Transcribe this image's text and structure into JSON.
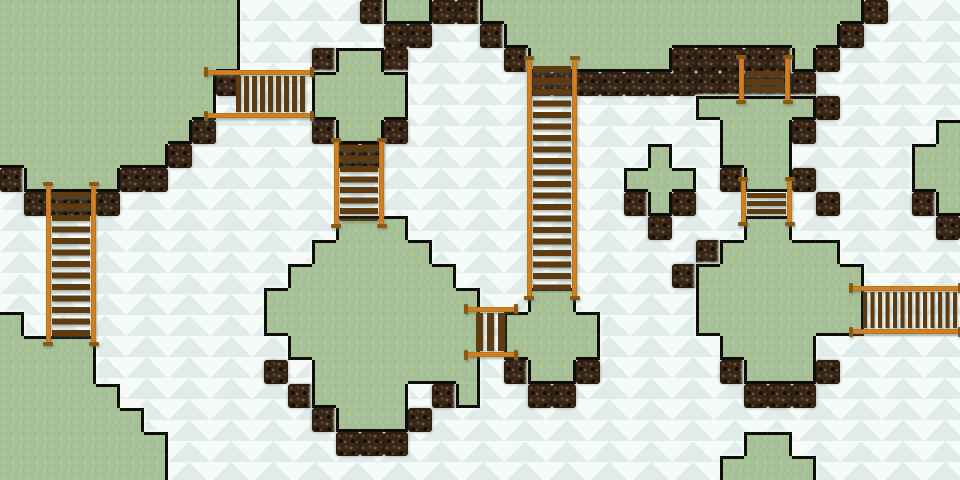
{
  "scene": {
    "name": "island-bridges-overworld-map",
    "width": 960,
    "height": 480,
    "tile_size": 24,
    "cols": 40,
    "rows": 20
  },
  "palette": {
    "water_base": "#ebf4f1",
    "water_scale_dark": "#dfecea",
    "water_scale_light": "#f6fbf9",
    "grass": "#a5c094",
    "outline": "#0d0d0b",
    "halo": "rgba(244,250,240,0.85)",
    "dock_base": "#3a291a",
    "dock_dark": "#1d1209",
    "rail": "#d08020",
    "rail_dark": "#8a5a10",
    "plank": "#5f3b12"
  },
  "tilemap": {
    "legend": {
      ".": "water",
      "g": "grass",
      "d": "dock"
    },
    "rows": [
      "gggggggggg.....dggddggggggggggggggggd...",
      "gggggggggg......dd..dggggggggggggggd....",
      "gggggggggg...dggd....dggggggdddddgd.....",
      "gggggggggd...gggg.....dddddddddddd......",
      "ggggggggg....gggg............gggggd.....",
      "ggggggggd....dggd.............gggd.....g",
      "gggggggd......dd...........g..ggg.....gg",
      "dggggdd...................ggg.dggd....gg",
      ".dddd.....................dgd.....d...dg",
      "..............ggg..........d...gg......d",
      ".............ggggg...........dggggg.....",
      "............ggggggg.........dggggggg....",
      "...........ggggggggg..gg.....ggggggg....",
      "g..........ggggggggg.gggg....ggggggg....",
      "gggg........gggggggg.gggg.....gggg......",
      "gggg.......d.ggggggg.dggd.....dgggd.....",
      "ggggg.......dgggg.dg..dd.......ddd......",
      "gggggg.......dgggd......................",
      "ggggggg.......ddd..............gg.......",
      "ggggggg.......................gggg......"
    ]
  },
  "bridges": [
    {
      "id": "bridge-west-horizontal",
      "orientation": "horizontal",
      "x": 206,
      "y": 70,
      "length": 106,
      "breadth": 48,
      "deck_start": 30,
      "deck_end": 102,
      "plank_period": 8,
      "plank_thickness": 5
    },
    {
      "id": "bridge-cross-island-vertical",
      "orientation": "vertical",
      "x": 334,
      "y": 140,
      "length": 86,
      "breadth": 50,
      "deck_start": 5,
      "deck_end": 81,
      "plank_period": 10.5,
      "plank_thickness": 6
    },
    {
      "id": "bridge-west-tall-vertical",
      "orientation": "vertical",
      "x": 46,
      "y": 184,
      "length": 160,
      "breadth": 50,
      "deck_start": 8,
      "deck_end": 152,
      "plank_period": 11.5,
      "plank_thickness": 6
    },
    {
      "id": "bridge-center-tall-vertical",
      "orientation": "vertical",
      "x": 527,
      "y": 58,
      "length": 240,
      "breadth": 50,
      "deck_start": 8,
      "deck_end": 232,
      "plank_period": 11.5,
      "plank_thickness": 6
    },
    {
      "id": "bridge-east-horizontal",
      "orientation": "horizontal",
      "x": 851,
      "y": 286,
      "length": 109,
      "breadth": 48,
      "deck_start": 12,
      "deck_end": 109,
      "plank_period": 7.5,
      "plank_thickness": 4
    },
    {
      "id": "bridge-channel-mini-vertical",
      "orientation": "vertical",
      "x": 739,
      "y": 57,
      "length": 45,
      "breadth": 51,
      "deck_start": 14,
      "deck_end": 38,
      "plank_period": 8,
      "plank_thickness": 5
    },
    {
      "id": "bridge-peninsula-mini-vertical",
      "orientation": "vertical",
      "x": 741,
      "y": 179,
      "length": 45,
      "breadth": 51,
      "deck_start": 14,
      "deck_end": 38,
      "plank_period": 8,
      "plank_thickness": 5
    },
    {
      "id": "bridge-inlet-mini-horizontal",
      "orientation": "horizontal",
      "x": 466,
      "y": 307,
      "length": 50,
      "breadth": 50,
      "deck_start": 10,
      "deck_end": 42,
      "plank_period": 11,
      "plank_thickness": 7
    }
  ]
}
